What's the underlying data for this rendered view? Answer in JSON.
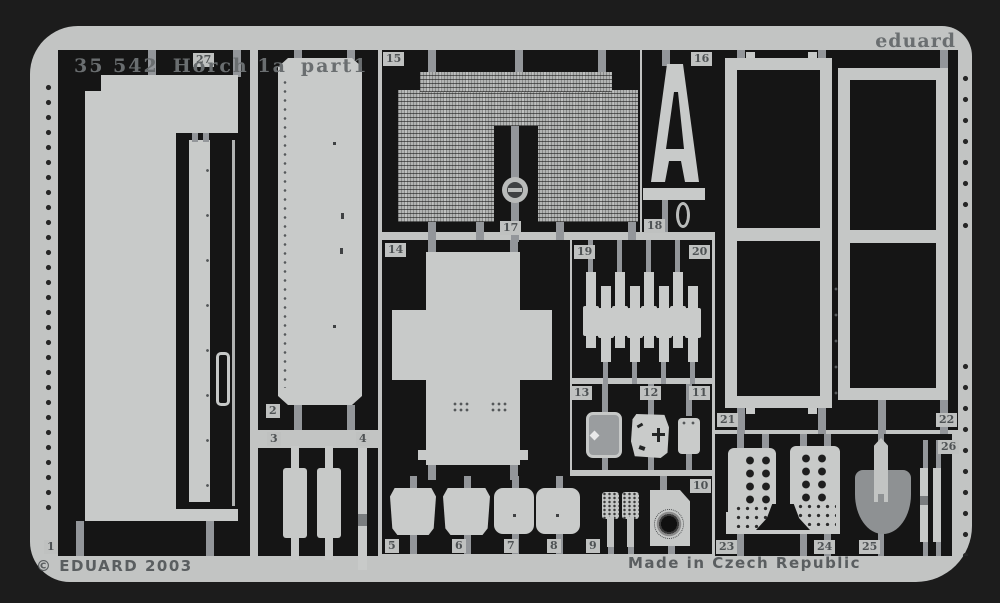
{
  "product": {
    "code": "35 542",
    "name": "Horch 1a",
    "part": "part1",
    "brand": "eduard",
    "copyright": "© EDUARD 2003",
    "made_in": "Made in Czech Republic"
  },
  "colors": {
    "background": "#1c1c1c",
    "sheet": "#c2c4c3",
    "cutout": "#151515",
    "part": "#c8cac9",
    "text": "#5a5e60"
  },
  "part_labels": [
    {
      "n": "27",
      "x": 193,
      "y": 53
    },
    {
      "n": "15",
      "x": 383,
      "y": 52
    },
    {
      "n": "16",
      "x": 691,
      "y": 52
    },
    {
      "n": "17",
      "x": 500,
      "y": 221
    },
    {
      "n": "18",
      "x": 644,
      "y": 219
    },
    {
      "n": "14",
      "x": 385,
      "y": 243
    },
    {
      "n": "19",
      "x": 574,
      "y": 245
    },
    {
      "n": "20",
      "x": 689,
      "y": 245
    },
    {
      "n": "13",
      "x": 571,
      "y": 386
    },
    {
      "n": "12",
      "x": 640,
      "y": 386
    },
    {
      "n": "11",
      "x": 689,
      "y": 386
    },
    {
      "n": "2",
      "x": 266,
      "y": 404
    },
    {
      "n": "3",
      "x": 267,
      "y": 432
    },
    {
      "n": "4",
      "x": 356,
      "y": 432
    },
    {
      "n": "21",
      "x": 717,
      "y": 413
    },
    {
      "n": "22",
      "x": 936,
      "y": 413
    },
    {
      "n": "26",
      "x": 938,
      "y": 440
    },
    {
      "n": "1",
      "x": 44,
      "y": 540
    },
    {
      "n": "5",
      "x": 385,
      "y": 539
    },
    {
      "n": "6",
      "x": 452,
      "y": 539
    },
    {
      "n": "7",
      "x": 504,
      "y": 539
    },
    {
      "n": "8",
      "x": 547,
      "y": 539
    },
    {
      "n": "9",
      "x": 586,
      "y": 539
    },
    {
      "n": "10",
      "x": 690,
      "y": 479
    },
    {
      "n": "23",
      "x": 716,
      "y": 540
    },
    {
      "n": "24",
      "x": 814,
      "y": 540
    },
    {
      "n": "25",
      "x": 859,
      "y": 540
    }
  ]
}
